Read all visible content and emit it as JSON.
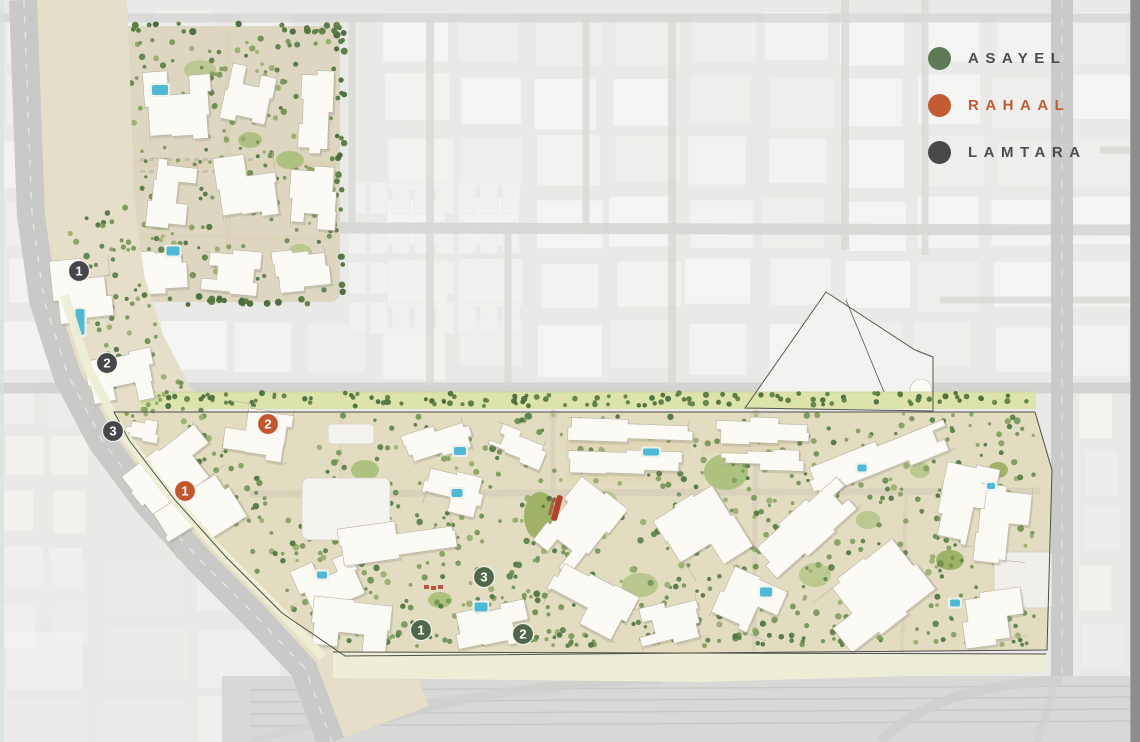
{
  "legend": {
    "items": [
      {
        "id": "asayel",
        "label": "ASAYEL",
        "dot_color": "#5d7a54",
        "label_color": "#4d4d4d"
      },
      {
        "id": "rahaal",
        "label": "RAHAAL",
        "dot_color": "#c25a33",
        "label_color": "#bd5c36"
      },
      {
        "id": "lamtara",
        "label": "LAMTARA",
        "dot_color": "#48484a",
        "label_color": "#4d4d4d"
      }
    ]
  },
  "markers": [
    {
      "group": "lamtara",
      "number": "1",
      "x": 79,
      "y": 271,
      "color": "#47474a"
    },
    {
      "group": "lamtara",
      "number": "2",
      "x": 107,
      "y": 363,
      "color": "#47474a"
    },
    {
      "group": "lamtara",
      "number": "3",
      "x": 113,
      "y": 431,
      "color": "#47474a"
    },
    {
      "group": "rahaal",
      "number": "2",
      "x": 268,
      "y": 424,
      "color": "#c2572e"
    },
    {
      "group": "rahaal",
      "number": "1",
      "x": 185,
      "y": 491,
      "color": "#c2572e"
    },
    {
      "group": "asayel",
      "number": "3",
      "x": 484,
      "y": 577,
      "color": "#50674a"
    },
    {
      "group": "asayel",
      "number": "1",
      "x": 421,
      "y": 630,
      "color": "#50674a"
    },
    {
      "group": "asayel",
      "number": "2",
      "x": 523,
      "y": 634,
      "color": "#50674a"
    }
  ],
  "map": {
    "type": "masterplan-site-map",
    "marker_ring_color": "#ffffff",
    "boundary_color": "#4f4e49"
  }
}
